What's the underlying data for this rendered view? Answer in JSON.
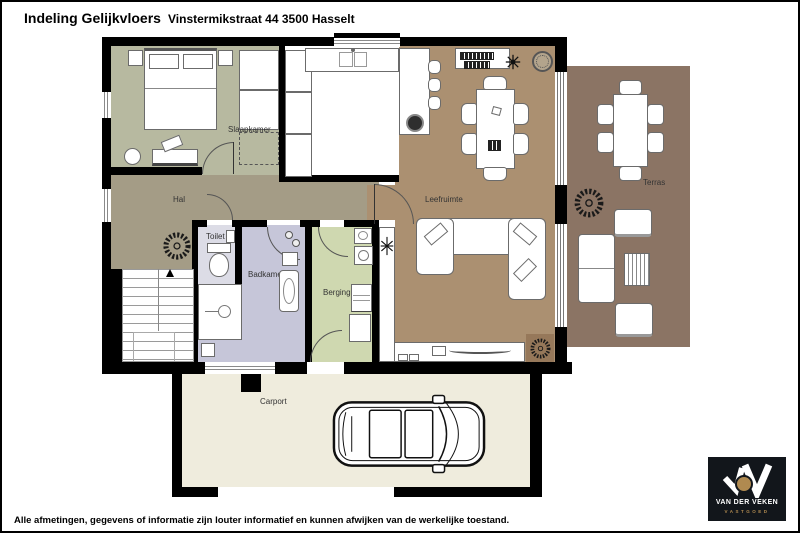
{
  "header": {
    "title": "Indeling Gelijkvloers",
    "address": "Vinstermikstraat 44  3500 Hasselt"
  },
  "rooms": {
    "slaapkamer": {
      "label": "Slaapkamer"
    },
    "hal": {
      "label": "Hal"
    },
    "toilet": {
      "label": "Toilet"
    },
    "badkamer": {
      "label": "Badkamer"
    },
    "berging": {
      "label": "Berging"
    },
    "leefruimte": {
      "label": "Leefruimte"
    },
    "terras": {
      "label": "Terras"
    },
    "carport": {
      "label": "Carport"
    }
  },
  "colors": {
    "wall": "#000000",
    "slaapkamer_floor": "#b7b9a0",
    "hal_floor": "#a49c86",
    "toilet_floor": "#dcdce6",
    "badkamer_floor": "#c6c6d9",
    "berging_floor": "#cfd8b0",
    "leefruimte_floor": "#ab9071",
    "terras_floor": "#8b7464",
    "carport_floor": "#efecdd",
    "plant_square": "#96785a",
    "logo_bg": "#12161b",
    "logo_gold": "#b08a50"
  },
  "footer": {
    "disclaimer": "Alle afmetingen, gegevens of informatie zijn louter informatief en kunnen afwijken van de werkelijke toestand."
  },
  "logo": {
    "name": "VAN DER VEKEN",
    "tagline": "VASTGOED"
  }
}
